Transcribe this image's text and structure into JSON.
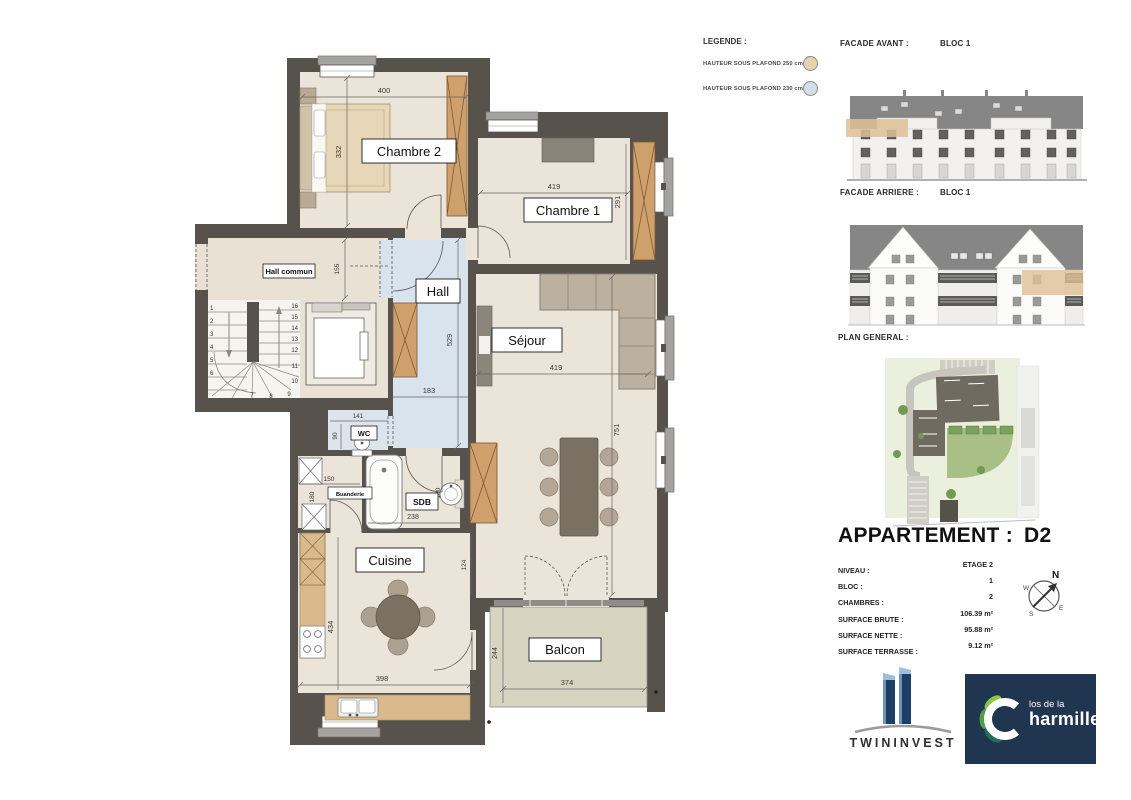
{
  "plan": {
    "rooms": {
      "chambre2": "Chambre 2",
      "chambre1": "Chambre 1",
      "hall": "Hall",
      "hall_commun": "Hall commun",
      "wc": "WC",
      "sdb": "SDB",
      "buanderie": "Buanderie",
      "cuisine": "Cuisine",
      "sejour": "Séjour",
      "balcon": "Balcon"
    },
    "dims": {
      "chambre2_w": "400",
      "chambre2_h": "332",
      "hall_commun_h": "155",
      "chambre1_w": "419",
      "chambre1_h": "291",
      "hall_h": "529",
      "hall_w": "183",
      "wc_w": "141",
      "wc_h": "90",
      "buanderie_w": "150",
      "buanderie_h": "180",
      "sdb_w": "238",
      "sdb_h": "180",
      "cuisine_h": "434",
      "cuisine_w": "398",
      "cuisine_right": "124",
      "sejour_w": "419",
      "sejour_h": "751",
      "balcon_h": "244",
      "balcon_w": "374"
    },
    "stairs_steps": [
      "1",
      "2",
      "3",
      "4",
      "5",
      "6",
      "7",
      "8",
      "9",
      "10",
      "11",
      "12",
      "13",
      "14",
      "15",
      "16"
    ]
  },
  "legend": {
    "title": "LEGENDE :",
    "items": [
      {
        "label": "HAUTEUR SOUS PLAFOND 250 cm",
        "color": "#e6d3ae"
      },
      {
        "label": "HAUTEUR SOUS PLAFOND 230 cm",
        "color": "#d3e0ec"
      }
    ]
  },
  "facades": {
    "avant_title": "FACADE AVANT :",
    "avant_bloc": "BLOC 1",
    "arriere_title": "FACADE ARRIERE :",
    "arriere_bloc": "BLOC 1"
  },
  "site": {
    "title": "PLAN GENERAL :"
  },
  "apartment": {
    "title": "APPARTEMENT :",
    "unit": "D2",
    "niveau_label": "NIVEAU :",
    "niveau": "ETAGE 2",
    "bloc_label": "BLOC :",
    "bloc": "1",
    "chambres_label": "CHAMBRES :",
    "chambres": "2",
    "surface_brute_label": "SURFACE BRUTE :",
    "surface_brute": "106.39 m²",
    "surface_nette_label": "SURFACE NETTE :",
    "surface_nette": "95.88 m²",
    "surface_terrasse_label": "SURFACE TERRASSE :",
    "surface_terrasse": "9.12 m²"
  },
  "compass": {
    "n": "N",
    "e": "E",
    "s": "S",
    "w": "W"
  },
  "branding": {
    "twininvest": "TWININVEST",
    "charmille_top": "los de la",
    "charmille_bottom": "harmille"
  },
  "colors": {
    "wall": "#57524c",
    "floor_cream": "#ebe4d9",
    "hall_floor_blue": "#d9e3ee",
    "balcony_floor": "#d8d4c2",
    "column_tan": "#cfa06b",
    "highlight_tan": "#dfc096",
    "brand_navy": "#20354f",
    "leaf_light_green": "#8cc63f",
    "leaf_dark_teal": "#1d6e5e"
  }
}
